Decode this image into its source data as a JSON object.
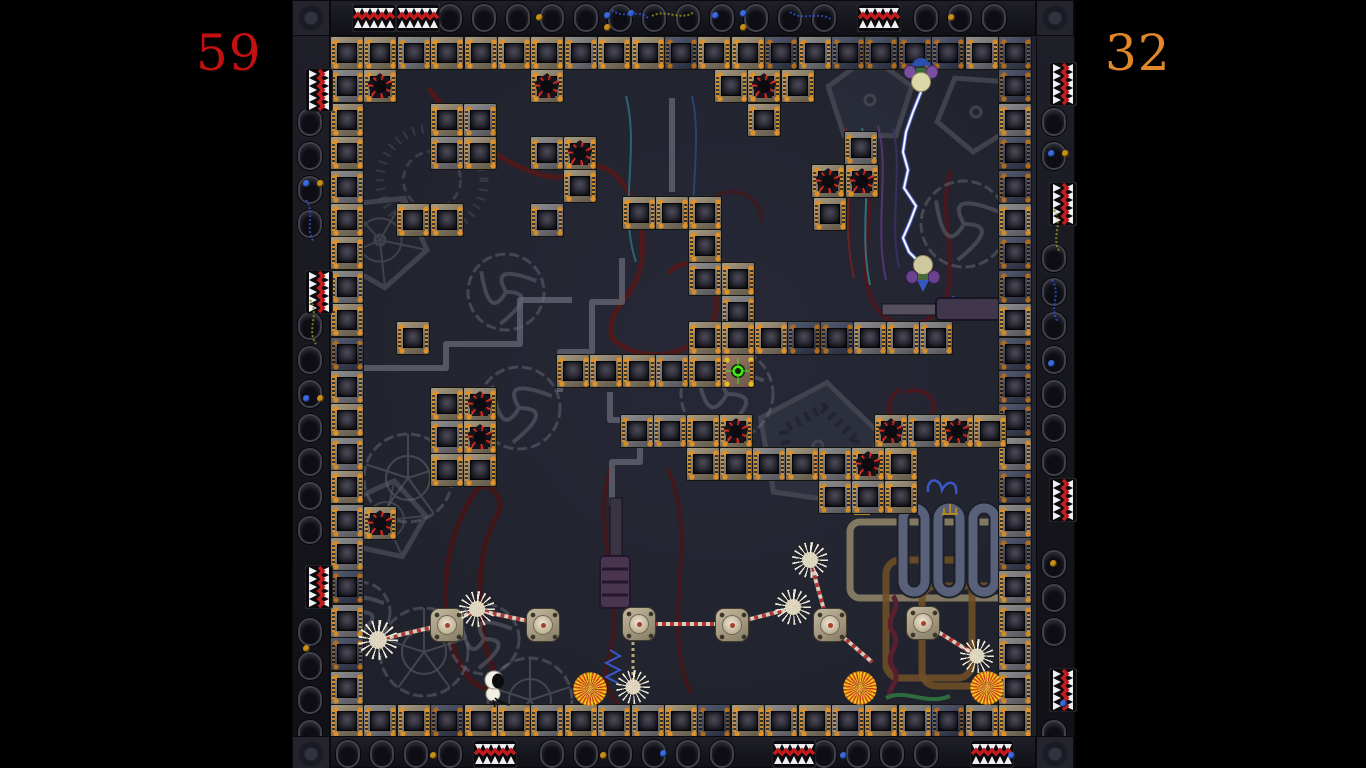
{
  "hud": {
    "score_left": "59",
    "score_right": "32",
    "score_left_color": "#c31111",
    "score_right_color": "#e0872c"
  },
  "palette": {
    "outside": "#000000",
    "field_bg": "#232531",
    "border_bg": "#17171e",
    "tile_tan": "#8a7f6a",
    "tile_grey": "#76767c",
    "tile_dark": "#3c4154",
    "hazard_red": "#e03424",
    "exit_green": "#46e416",
    "lightning_core": "#ffffff",
    "lightning_glow": "#5577ff",
    "strand_light": "#d6cfc0",
    "strand_red": "#b23434"
  },
  "layout": {
    "bar_left_w": 292,
    "bar_right_x": 1075,
    "field": {
      "x": 330,
      "y": 36,
      "w": 706,
      "h": 700
    },
    "bands": {
      "top": [
        330,
        0,
        706,
        36
      ],
      "bottom": [
        330,
        736,
        706,
        32
      ],
      "left": [
        292,
        0,
        38,
        768
      ],
      "right": [
        1036,
        0,
        39,
        768
      ]
    }
  },
  "tiles": {
    "size": 33.4,
    "top_row": {
      "x": 330,
      "y": 36,
      "types": "ttgttttgttdttdgddddgd"
    },
    "left_col": {
      "x": 330,
      "y": 36,
      "types": "gttgttgtdgtgtggdgdg"
    },
    "right_col": {
      "x": 998,
      "y": 36,
      "types": "dgddgddgdddgdgdgggg"
    },
    "floor_row": {
      "x": 330,
      "y": 704,
      "types": "tgtdttgtggtdtgtgtgdgt"
    },
    "interior": [
      [
        363,
        69,
        "r"
      ],
      [
        530,
        69,
        "r"
      ],
      [
        714,
        69,
        "t"
      ],
      [
        747,
        69,
        "r"
      ],
      [
        781,
        69,
        "t"
      ],
      [
        747,
        103,
        "t"
      ],
      [
        844,
        131,
        "g"
      ],
      [
        811,
        164,
        "r"
      ],
      [
        845,
        164,
        "r"
      ],
      [
        813,
        197,
        "t"
      ],
      [
        430,
        103,
        "t"
      ],
      [
        463,
        103,
        "g"
      ],
      [
        430,
        136,
        "g"
      ],
      [
        463,
        136,
        "t"
      ],
      [
        530,
        136,
        "g"
      ],
      [
        563,
        136,
        "r"
      ],
      [
        563,
        169,
        "t"
      ],
      [
        396,
        203,
        "t"
      ],
      [
        430,
        203,
        "t"
      ],
      [
        530,
        203,
        "g"
      ],
      [
        622,
        196,
        "t"
      ],
      [
        655,
        196,
        "t"
      ],
      [
        688,
        196,
        "t"
      ],
      [
        688,
        229,
        "t"
      ],
      [
        688,
        262,
        "g"
      ],
      [
        721,
        262,
        "t"
      ],
      [
        721,
        295,
        "g"
      ],
      [
        688,
        321,
        "t"
      ],
      [
        721,
        321,
        "t"
      ],
      [
        754,
        321,
        "t"
      ],
      [
        787,
        321,
        "d"
      ],
      [
        820,
        321,
        "d"
      ],
      [
        853,
        321,
        "g"
      ],
      [
        886,
        321,
        "g"
      ],
      [
        919,
        321,
        "g"
      ],
      [
        396,
        321,
        "t"
      ],
      [
        556,
        354,
        "t"
      ],
      [
        589,
        354,
        "t"
      ],
      [
        622,
        354,
        "t"
      ],
      [
        655,
        354,
        "g"
      ],
      [
        688,
        354,
        "t"
      ],
      [
        721,
        354,
        "s"
      ],
      [
        430,
        387,
        "t"
      ],
      [
        463,
        387,
        "r"
      ],
      [
        430,
        420,
        "g"
      ],
      [
        463,
        420,
        "r"
      ],
      [
        430,
        453,
        "t"
      ],
      [
        463,
        453,
        "t"
      ],
      [
        620,
        414,
        "g"
      ],
      [
        653,
        414,
        "g"
      ],
      [
        686,
        414,
        "t"
      ],
      [
        719,
        414,
        "r"
      ],
      [
        874,
        414,
        "r"
      ],
      [
        907,
        414,
        "g"
      ],
      [
        940,
        414,
        "r"
      ],
      [
        973,
        414,
        "t"
      ],
      [
        686,
        447,
        "t"
      ],
      [
        719,
        447,
        "t"
      ],
      [
        752,
        447,
        "g"
      ],
      [
        785,
        447,
        "t"
      ],
      [
        818,
        447,
        "g"
      ],
      [
        851,
        447,
        "r"
      ],
      [
        884,
        447,
        "t"
      ],
      [
        818,
        480,
        "g"
      ],
      [
        851,
        480,
        "g"
      ],
      [
        884,
        480,
        "t"
      ],
      [
        363,
        506,
        "r"
      ]
    ]
  },
  "pods": [
    [
      430,
      608
    ],
    [
      526,
      608
    ],
    [
      622,
      607
    ],
    [
      715,
      608
    ],
    [
      813,
      608
    ],
    [
      906,
      606
    ]
  ],
  "mines": [
    [
      378,
      640,
      20
    ],
    [
      477,
      609,
      18
    ],
    [
      633,
      687,
      17
    ],
    [
      793,
      607,
      18
    ],
    [
      810,
      560,
      18
    ],
    [
      977,
      656,
      17
    ]
  ],
  "orbs": [
    [
      590,
      689
    ],
    [
      860,
      688
    ],
    [
      987,
      688
    ]
  ],
  "strands": [
    [
      378,
      640,
      446,
      624
    ],
    [
      446,
      624,
      477,
      610
    ],
    [
      477,
      610,
      542,
      624
    ],
    [
      638,
      624,
      731,
      624
    ],
    [
      731,
      624,
      793,
      608
    ],
    [
      810,
      560,
      828,
      624
    ],
    [
      922,
      622,
      977,
      656
    ],
    [
      828,
      624,
      872,
      662
    ]
  ],
  "chain": [
    633,
    642,
    633,
    680
  ],
  "lightning": [
    [
      921,
      92
    ],
    [
      913,
      112
    ],
    [
      906,
      132
    ],
    [
      903,
      152
    ],
    [
      908,
      170
    ],
    [
      904,
      188
    ],
    [
      916,
      206
    ],
    [
      910,
      222
    ],
    [
      903,
      238
    ],
    [
      909,
      252
    ],
    [
      917,
      260
    ]
  ],
  "creature": {
    "x": 482,
    "y": 670
  },
  "bats": {
    "top": {
      "x": 904,
      "y": 58
    },
    "bottom": {
      "x": 906,
      "y": 254
    }
  },
  "border": {
    "teeth": {
      "top": [
        352,
        396,
        857
      ],
      "bottom": [
        473,
        772,
        970
      ],
      "left": [
        68,
        270,
        565
      ],
      "right": [
        62,
        182,
        478,
        668
      ]
    },
    "dots": [
      [
        604,
        12,
        "b"
      ],
      [
        604,
        24,
        "a"
      ],
      [
        628,
        10,
        "b"
      ],
      [
        712,
        12,
        "b"
      ],
      [
        740,
        10,
        "b"
      ],
      [
        740,
        24,
        "a"
      ],
      [
        948,
        14,
        "a"
      ],
      [
        536,
        14,
        "a"
      ],
      [
        303,
        180,
        "b"
      ],
      [
        317,
        180,
        "a"
      ],
      [
        303,
        395,
        "b"
      ],
      [
        317,
        395,
        "a"
      ],
      [
        303,
        645,
        "a"
      ],
      [
        1048,
        150,
        "b"
      ],
      [
        1062,
        150,
        "a"
      ],
      [
        1048,
        360,
        "b"
      ],
      [
        1050,
        560,
        "a"
      ],
      [
        1060,
        700,
        "b"
      ],
      [
        600,
        752,
        "a"
      ],
      [
        660,
        750,
        "b"
      ],
      [
        840,
        752,
        "b"
      ],
      [
        430,
        752,
        "a"
      ],
      [
        1008,
        752,
        "b"
      ]
    ]
  },
  "decor": {
    "gears": [
      {
        "k": "pent",
        "x": 870,
        "y": 100,
        "r": 44,
        "rot": -18,
        "f": "#2e3240"
      },
      {
        "k": "pent",
        "x": 976,
        "y": 112,
        "r": 40,
        "rot": 22,
        "f": "none"
      },
      {
        "k": "pent",
        "x": 818,
        "y": 446,
        "r": 64,
        "rot": -10,
        "f": "#353a46",
        "teeth": true
      },
      {
        "k": "pent",
        "x": 380,
        "y": 240,
        "r": 48,
        "rot": 12,
        "f": "none",
        "web": true
      },
      {
        "k": "pent",
        "x": 386,
        "y": 520,
        "r": 40,
        "rot": -6,
        "f": "none",
        "web": true
      },
      {
        "k": "ring",
        "x": 506,
        "y": 292,
        "r": 38,
        "swirl": true
      },
      {
        "k": "ring",
        "x": 519,
        "y": 408,
        "r": 41,
        "swirl": true
      },
      {
        "k": "ring",
        "x": 408,
        "y": 478,
        "r": 44,
        "web": true
      },
      {
        "k": "ring",
        "x": 727,
        "y": 394,
        "r": 46,
        "swirl": true
      },
      {
        "k": "ring",
        "x": 964,
        "y": 224,
        "r": 43,
        "swirl": true
      },
      {
        "k": "ring",
        "x": 424,
        "y": 652,
        "r": 44,
        "web": true
      },
      {
        "k": "ring",
        "x": 484,
        "y": 639,
        "r": 35,
        "swirl": true
      },
      {
        "k": "ring",
        "x": 530,
        "y": 700,
        "r": 42,
        "web": true
      },
      {
        "k": "ring",
        "x": 360,
        "y": 612,
        "r": 30,
        "swirl": true
      },
      {
        "k": "burst",
        "x": 432,
        "y": 180,
        "r": 52
      }
    ],
    "pipes": [
      "M333,368 L446,368 L446,344 L520,344 L520,300 L572,300",
      "M560,392 L560,352 L592,352 L592,302 L622,302 L622,258",
      "M612,506 L612,462 L640,462 L640,420 L610,420 L610,392",
      "M672,98 L672,192"
    ],
    "doodles": [
      {
        "d": "M430,90 C480,160 555,190 575,172 C610,145 648,205 642,258 C638,300 604,306 612,338",
        "c": "#5a1616",
        "w": 5,
        "o": 0.8
      },
      {
        "d": "M612,338 C646,372 712,350 716,310 C720,272 686,252 670,272",
        "c": "#5a1616",
        "w": 5,
        "o": 0.8
      },
      {
        "d": "M864,148 C884,200 852,252 872,300 C888,336 934,330 946,298 C958,262 938,210 950,172",
        "c": "#54141a",
        "w": 4,
        "o": 0.8
      },
      {
        "d": "M898,390 C876,410 900,436 922,424 C946,410 930,384 906,392",
        "c": "#54141a",
        "w": 4,
        "o": 0.8
      },
      {
        "d": "M478,488 C440,540 436,620 462,668 C472,686 492,696 498,682 C478,640 470,560 498,514 C506,500 490,480 478,488",
        "c": "#4e1212",
        "w": 5,
        "o": 0.75
      },
      {
        "d": "M610,470 C590,530 628,600 608,660 C600,686 614,698 620,708",
        "c": "#4e1212",
        "w": 4,
        "o": 0.7
      },
      {
        "d": "M668,470 C700,540 660,620 690,692",
        "c": "#4e1212",
        "w": 4,
        "o": 0.7
      },
      {
        "d": "M700,210 C720,180 760,190 762,220",
        "c": "#4e1212",
        "w": 4,
        "o": 0.5
      }
    ],
    "wires": [
      {
        "d": "M846,128 C856,170 840,220 854,278",
        "c": "#7a2020"
      },
      {
        "d": "M862,128 C874,175 858,230 870,285",
        "c": "#2e7f86"
      },
      {
        "d": "M878,126 C890,170 874,225 886,280",
        "c": "#5a3a7e"
      },
      {
        "d": "M893,128 C903,168 889,222 899,268",
        "c": "#37346a"
      },
      {
        "d": "M626,96 C640,150 618,210 636,262",
        "c": "#2e6f80"
      },
      {
        "d": "M692,96 C704,150 684,205 700,258",
        "c": "#274a78"
      },
      {
        "d": "M952,297 L985,301",
        "c": "#3a57c8",
        "dash": "3,3"
      }
    ],
    "border_wires": [
      {
        "d": "M612,10 C624,20 636,8 648,18",
        "c": "#2a50c0"
      },
      {
        "d": "M652,16 C666,8 680,22 694,12",
        "c": "#8a8a20"
      },
      {
        "d": "M790,12 C804,22 818,10 832,20",
        "c": "#2a50c0"
      },
      {
        "d": "M306,200 C316,214 304,228 314,242",
        "c": "#2a50c0"
      },
      {
        "d": "M310,300 C320,314 306,330 316,344",
        "c": "#8a8a20"
      },
      {
        "d": "M1054,210 C1064,224 1050,238 1060,252",
        "c": "#8a8a20"
      },
      {
        "d": "M1052,280 C1062,294 1048,308 1058,322",
        "c": "#2a50c0"
      }
    ],
    "machines": {
      "tubes": [
        [
          903,
          508
        ],
        [
          938,
          508
        ],
        [
          973,
          508
        ]
      ],
      "tube_size": [
        22,
        84
      ],
      "frame": [
        850,
        522,
        158,
        76
      ],
      "brown_pipes": [
        [
          886,
          560,
          86,
          118
        ],
        [
          922,
          586,
          84,
          100
        ]
      ],
      "piston": {
        "x": 600,
        "y": 556,
        "w": 30,
        "h": 52,
        "rod": [
          610,
          498,
          12,
          60
        ]
      },
      "h_piston": {
        "body": [
          936,
          298,
          64,
          22
        ],
        "rod": [
          882,
          304,
          56,
          11
        ]
      },
      "coil": "M893,596 C903,610 883,618 893,632 C903,646 883,654 893,668 C903,682 885,688 891,698",
      "cord": "M886,698 C906,688 926,706 950,696",
      "spring": "M610,650 L620,656 L606,663 L620,670 L606,677 L618,683",
      "curls": [
        {
          "d": "M886,494 C884,480 896,478 898,490 C900,480 910,478 912,490",
          "c": "#a82424"
        },
        {
          "d": "M928,492 C926,478 940,476 942,490 C948,478 958,482 956,494",
          "c": "#3a57c8"
        }
      ],
      "tridents": [
        [
          862,
          514
        ],
        [
          950,
          514
        ]
      ]
    }
  }
}
